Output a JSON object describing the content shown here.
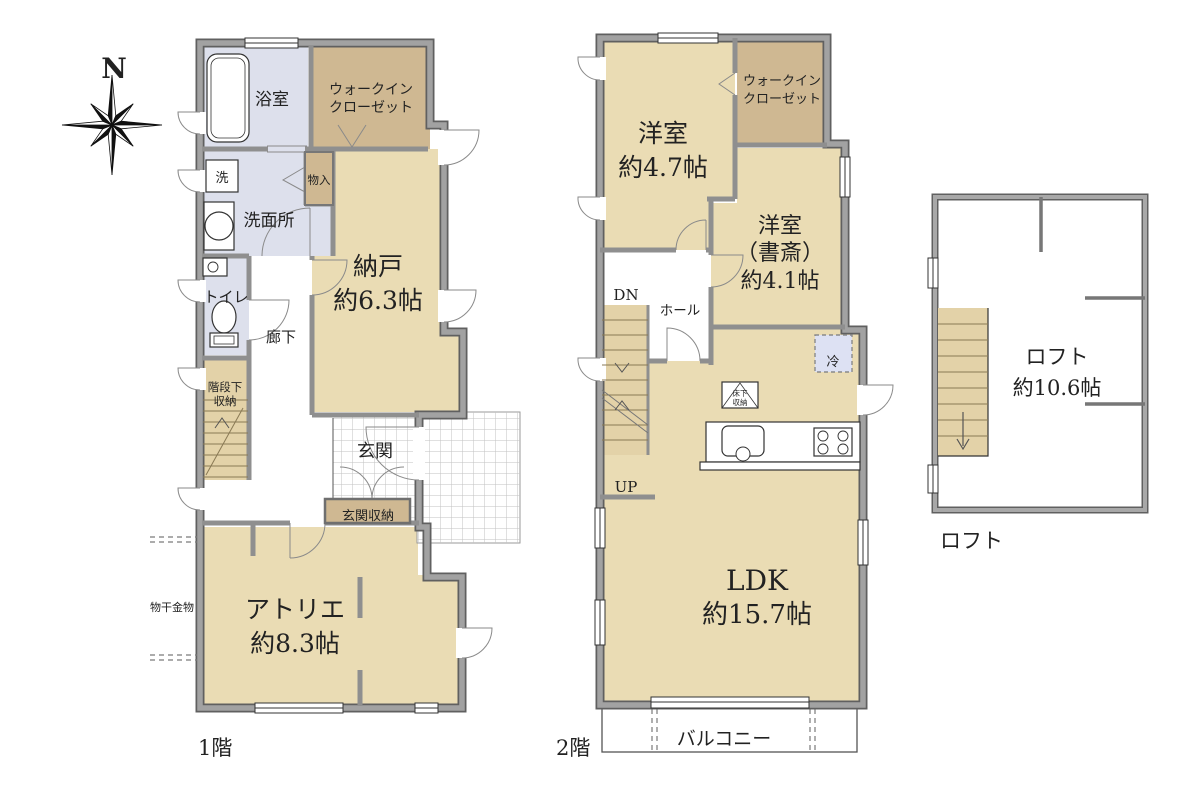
{
  "colors": {
    "wall": "#a2a2a2",
    "wall_edge": "#606060",
    "room_tan": "#eadcb4",
    "closet_tan": "#cfb892",
    "wet_area_blue": "#dde0ec",
    "stairs_tan": "#e3d2a8",
    "fridge_blue": "#dde1f3",
    "tile_line": "#c2c2c2",
    "text": "#222222"
  },
  "compass": {
    "north": "N"
  },
  "floor1": {
    "caption": "1階",
    "bath": "浴室",
    "wic_line1": "ウォークイン",
    "wic_line2": "クローゼット",
    "laundry": "洗",
    "washroom": "洗面所",
    "storage_small": "物入",
    "toilet": "トイレ",
    "hallway": "廊下",
    "nando_name": "納戸",
    "nando_size": "約6.3帖",
    "understair_line1": "階段下",
    "understair_line2": "収納",
    "genkan": "玄関",
    "genkan_storage": "玄関収納",
    "atelier_name": "アトリエ",
    "atelier_size": "約8.3帖",
    "drying_hardware": "物干金物"
  },
  "floor2": {
    "caption": "2階",
    "bedroom_name": "洋室",
    "bedroom_size": "約4.7帖",
    "wic_line1": "ウォークイン",
    "wic_line2": "クローゼット",
    "study_name": "洋室",
    "study_paren": "（書斎）",
    "study_size": "約4.1帖",
    "dn": "DN",
    "hall": "ホール",
    "up": "UP",
    "fridge": "冷",
    "floor_storage_line1": "床下",
    "floor_storage_line2": "収納",
    "ldk_name": "LDK",
    "ldk_size": "約15.7帖",
    "balcony": "バルコニー"
  },
  "loft": {
    "caption": "ロフト",
    "name": "ロフト",
    "size": "約10.6帖"
  }
}
